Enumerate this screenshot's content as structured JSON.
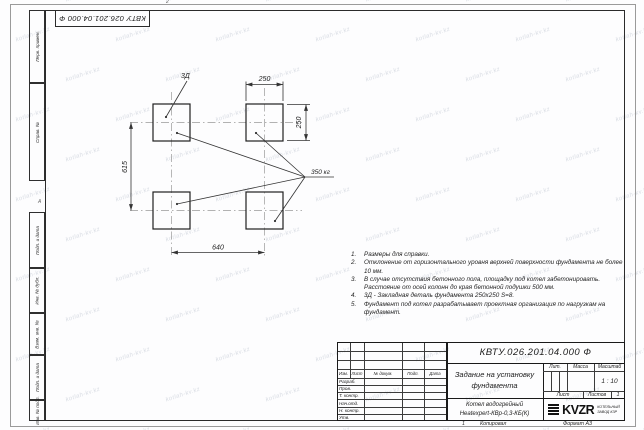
{
  "sheet": {
    "top_stamp": "КВТУ 026.201.04.000 Ф",
    "zone_letter": "А",
    "zone_number": "2"
  },
  "watermark": {
    "text": "kotlah-kv.kz"
  },
  "margin_boxes": [
    "Перв. примен.",
    "Справ. №",
    "Подп. и дата",
    "Инв. № дубл.",
    "Взам. инв. №",
    "Подп. и дата",
    "Инв. № подл."
  ],
  "drawing": {
    "dim_width_top": "250",
    "dim_height_right": "250",
    "dim_span_vertical": "615",
    "dim_span_horizontal": "640",
    "embed_label": "3Д",
    "weight_label": "350 кг"
  },
  "notes": [
    {
      "num": "1.",
      "text": "Размеры для справки."
    },
    {
      "num": "2.",
      "text": "Отклонение от горизонтального уровня верхней поверхности фундамента не более 10 мм."
    },
    {
      "num": "3.",
      "text": "В случае отсутствия бетонного пола, площадку под котел забетонировать. Расстояние от осей колонн до края бетонной подушки 500 мм."
    },
    {
      "num": "4.",
      "text": "3Д - Закладная деталь фундамента 250х250 S=8."
    },
    {
      "num": "5.",
      "text": "Фундамент под котел разрабатывает проектная организация по нагрузкам на фундамент."
    }
  ],
  "title_block": {
    "doc_number": "КВТУ.026.201.04.000 Ф",
    "title": "Задание на установку фундамента",
    "product_line1": "Котел водогрейный",
    "product_line2": "Heatexpert-КВр-0,3-КБ(К)",
    "header_cols": [
      "Изм.",
      "Лист",
      "№ докум.",
      "Подп.",
      "Дата"
    ],
    "sign_rows": [
      "Разраб.",
      "Пров.",
      "Т. контр.",
      "Нач.отд.",
      "Н. контр.",
      "Утв."
    ],
    "lit_label": "Лит.",
    "mass_label": "Масса",
    "scale_label": "Масштаб",
    "scale_value": "1 : 10",
    "sheet_label": "Лист",
    "sheets_label": "Листов",
    "sheets_value": "1",
    "logo_text": "KVZR",
    "org_line1": "КОТЕЛЬНЫЙ",
    "org_line2": "ЗАВОД КЗР"
  },
  "footer": {
    "copy_note": "1",
    "copied_label": "Копировал",
    "format_label": "Формат А3"
  }
}
